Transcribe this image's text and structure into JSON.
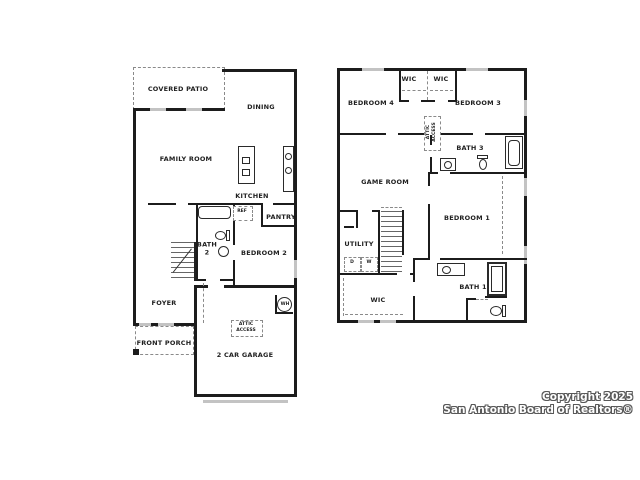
{
  "floor1": {
    "labels": {
      "covered_patio": "COVERED PATIO",
      "dining": "DINING",
      "family_room": "FAMILY ROOM",
      "kitchen": "KITCHEN",
      "pantry": "PANTRY",
      "ref": "REF",
      "bath2": "BATH 2",
      "bedroom2": "BEDROOM 2",
      "foyer": "FOYER",
      "front_porch": "FRONT PORCH",
      "attic_access": "ATTIC ACCESS",
      "garage": "2 CAR GARAGE",
      "water_heater": "WH"
    }
  },
  "floor2": {
    "labels": {
      "wic_left": "WIC",
      "wic_right": "WIC",
      "bedroom4": "BEDROOM 4",
      "bedroom3": "BEDROOM 3",
      "attic_access": "ATTIC ACCESS",
      "bath3": "BATH 3",
      "game_room": "GAME ROOM",
      "bedroom1": "BEDROOM 1",
      "utility": "UTILITY",
      "dryer": "D",
      "washer": "W",
      "wic_primary": "WIC",
      "bath1": "BATH 1"
    }
  },
  "footer": {
    "copyright_line1": "Copyright 2025",
    "copyright_line2": "San Antonio Board of Realtors®"
  },
  "colors": {
    "wall": "#1c1c1c",
    "window": "#c3c3c3",
    "label": "#1f1f1f"
  }
}
